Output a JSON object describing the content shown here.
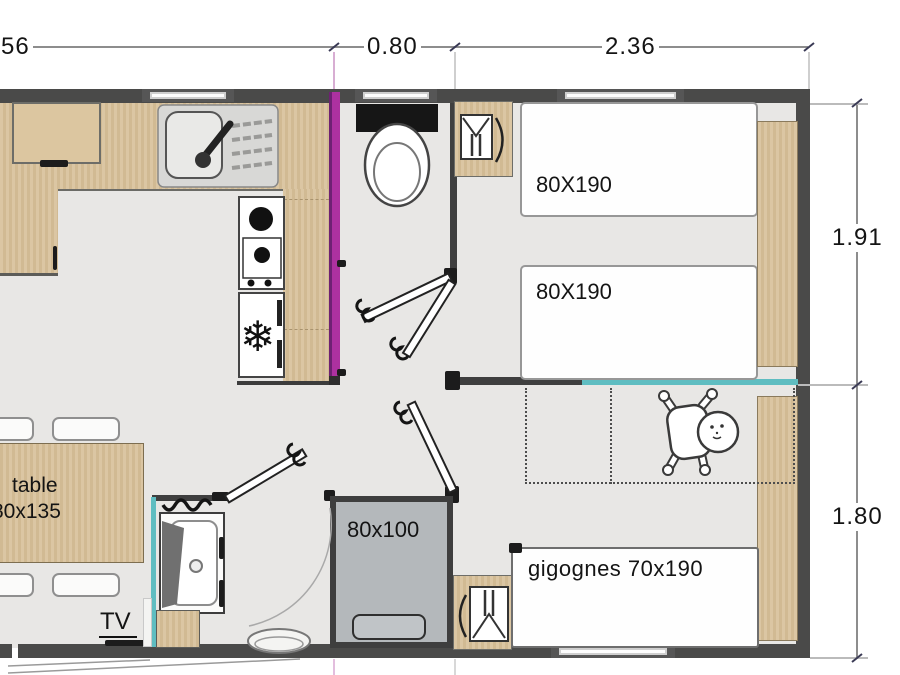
{
  "plan_title": "mobile-home floor plan",
  "dimensions": {
    "left_partial": "56",
    "wc_width": "0.80",
    "bedroom_width": "2.36",
    "bedroom1_depth": "1.91",
    "bedroom2_depth": "1.80"
  },
  "labels": {
    "bed1": "80X190",
    "bed2": "80X190",
    "bed_gigognes": "gigognes 70x190",
    "shower": "80x100",
    "table_line1": "table",
    "table_line2": "80x135",
    "tv": "TV"
  },
  "icons": {
    "snowflake_glyph": "❄",
    "names": [
      "sink-icon",
      "stove-icon",
      "fridge-snowflake-icon",
      "toilet-icon",
      "wardrobe-hanger-icon",
      "washbasin-icon",
      "baby-icon",
      "door-leaf-icon",
      "window-icon",
      "step-oval-icon"
    ]
  },
  "colors": {
    "wall": "#4a4a49",
    "interior_wall": "#3f3f3f",
    "wood": "#d8c19b",
    "floor": "#e8e7e5",
    "magenta_wall": "#ad31a0",
    "teal_accent": "#5fbdc1",
    "shower_gray": "#b4b8bb",
    "text": "#141414"
  }
}
